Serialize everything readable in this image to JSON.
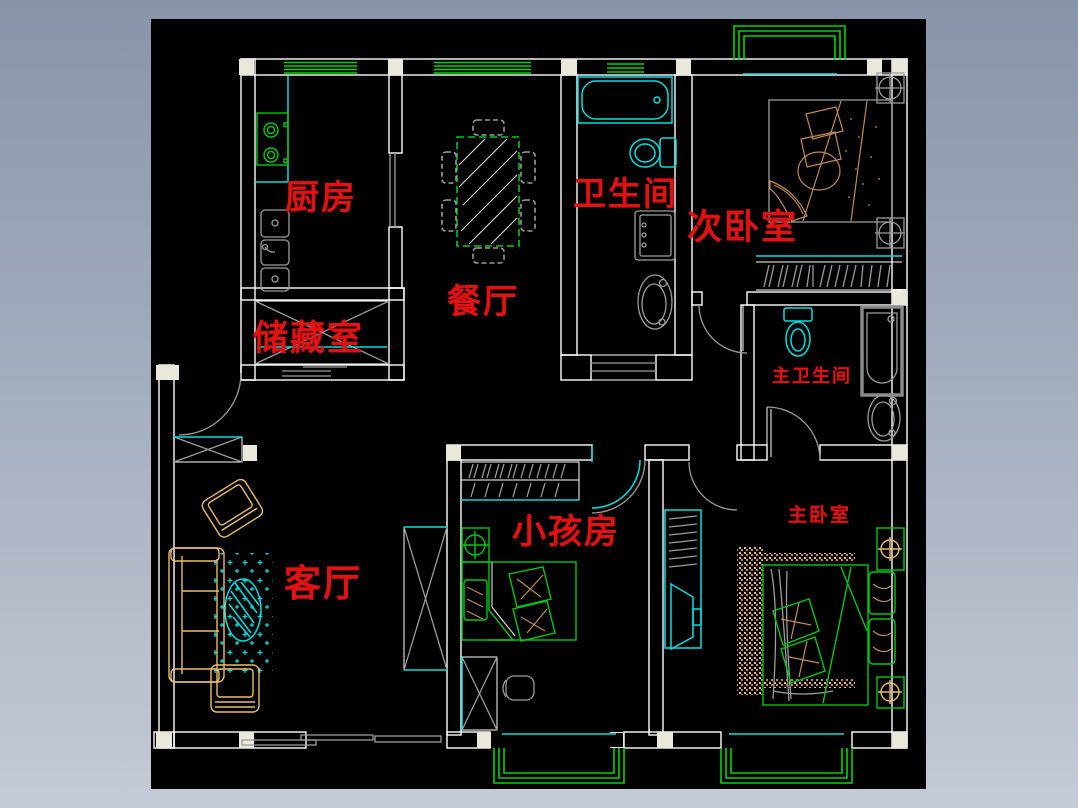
{
  "palette": {
    "frame_top": "#8894a9",
    "frame_bottom": "#c4cad6",
    "canvas_bg": "#000000",
    "wall": "#ffffff",
    "post": "#eae8da",
    "window_green": "#00d400",
    "furniture_green": "#00c818",
    "cyan": "#00e0e0",
    "gray": "#9c9c9c",
    "tan": "#c08b55",
    "wheat": "#e9be6b",
    "label_red": "#e11212"
  },
  "rooms": {
    "kitchen": {
      "label": "厨房"
    },
    "dining": {
      "label": "餐厅"
    },
    "bathroom": {
      "label": "卫生间"
    },
    "secondary_bedroom": {
      "label": "次卧室"
    },
    "storage": {
      "label": "储藏室"
    },
    "master_bathroom": {
      "label": "主卫生间"
    },
    "children_room": {
      "label": "小孩房"
    },
    "living_room": {
      "label": "客厅"
    },
    "master_bedroom": {
      "label": "主卧室"
    }
  },
  "fixture_icons": [
    "stove-icon",
    "kitchen-sink-icon",
    "counter-icon",
    "dining-table-icon",
    "dining-chair-icon",
    "bathtub-icon",
    "toilet-icon",
    "washing-machine-icon",
    "pedestal-sink-icon",
    "double-bed-icon",
    "single-bed-icon",
    "wardrobe-hangers-icon",
    "nightstand-icon",
    "sofa-icon",
    "armchair-icon",
    "coffee-table-icon",
    "rug-icon",
    "tv-cabinet-icon",
    "bay-window-icon",
    "window-icon",
    "door-swing-icon",
    "sliding-door-icon",
    "shoe-cabinet-icon",
    "storage-crate-icon",
    "column-crosshair-icon",
    "desk-chair-icon"
  ]
}
